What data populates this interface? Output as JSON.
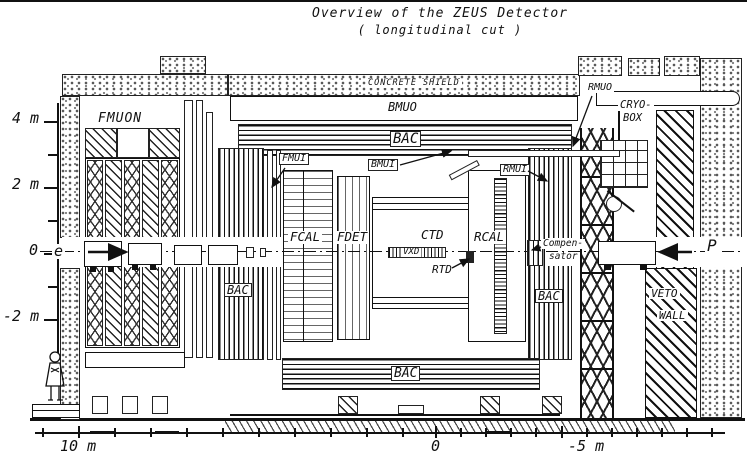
{
  "title": {
    "line1": "Overview of the ZEUS Detector",
    "line2": "( longitudinal cut )"
  },
  "y_axis": {
    "tick_4m": "4 m",
    "tick_2m": "2 m",
    "tick_0": "0",
    "tick_neg2m": "-2 m"
  },
  "x_axis": {
    "tick_10m": "10 m",
    "tick_0": "0",
    "tick_neg5m": "-5 m"
  },
  "beams": {
    "electron": "e",
    "proton": "P"
  },
  "labels": {
    "concrete_shield": "CONCRETE SHIELD",
    "bmuo": "BMUO",
    "bac_top": "BAC",
    "bac_left": "BAC",
    "bac_right": "BAC",
    "bac_bottom": "BAC",
    "fmuon": "FMUON",
    "fmui": "FMUI",
    "bmui": "BMUI",
    "rmui": "RMUI",
    "rmuo": "RMUO",
    "cryo_line1": "CRYO-",
    "cryo_line2": "BOX",
    "fcal": "FCAL",
    "fdet": "FDET",
    "ctd": "CTD",
    "vxd": "VXD",
    "rtd": "RTD",
    "rcal": "RCAL",
    "compensator_line1": "Compen-",
    "compensator_line2": "sator",
    "veto_line1": "VETO",
    "veto_line2": "WALL"
  }
}
